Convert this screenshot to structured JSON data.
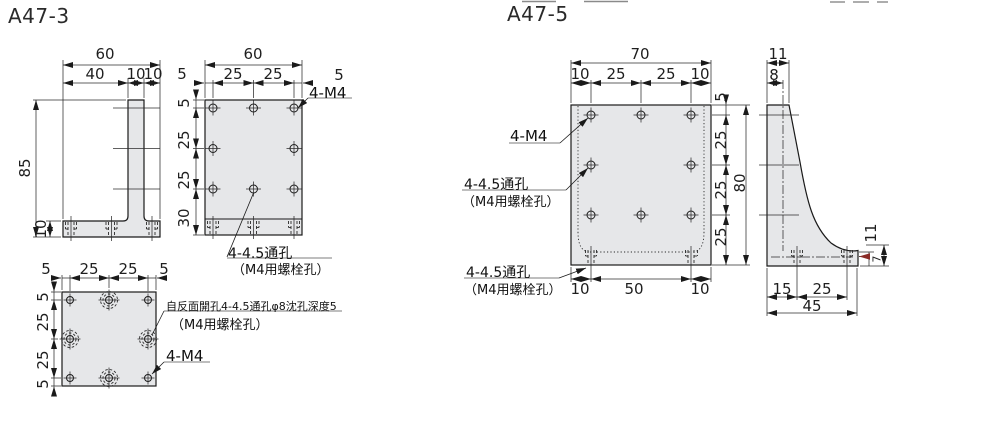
{
  "colors": {
    "background": "#ffffff",
    "part_fill": "#e6e7e9",
    "line": "#1a1a1a",
    "underline_gray": "#a9a9a9",
    "accent_arrow": "#8a2b26"
  },
  "a47_3": {
    "title": "A47-3",
    "side": {
      "w_total": "60",
      "w1": "40",
      "w2": "10",
      "w3": "10",
      "h_total": "85",
      "h_base": "10"
    },
    "front": {
      "w_total": "60",
      "m_l": "5",
      "p1": "25",
      "p2": "25",
      "m_r": "5",
      "v1": "5",
      "v2": "25",
      "v3": "25",
      "v4": "30",
      "tap": "4-M4",
      "hole1": "4-4.5通孔",
      "hole2": "（M4用螺栓孔）"
    },
    "bottom": {
      "m_l": "5",
      "p1": "25",
      "p2": "25",
      "m_r": "5",
      "v1": "5",
      "v2": "25",
      "v3": "25",
      "v4": "5",
      "cbore1": "自反面開孔4-4.5通孔φ8沈孔深度5",
      "cbore2": "（M4用螺栓孔）",
      "tap": "4-M4"
    }
  },
  "a47_5": {
    "title": "A47-5",
    "front": {
      "w_total": "70",
      "m_l": "10",
      "p1": "25",
      "p2": "25",
      "m_r": "10",
      "v1": "5",
      "v2": "25",
      "v3": "25",
      "v4": "25",
      "h_total": "80",
      "b1": "10",
      "b2": "50",
      "b3": "10",
      "tap": "4-M4",
      "hole1": "4-4.5通孔",
      "hole2": "（M4用螺栓孔）",
      "bhole1": "4-4.5通孔",
      "bhole2": "（M4用螺栓孔）"
    },
    "side": {
      "w_top": "11",
      "w_wall": "8",
      "tip_h": "11",
      "tip_t": "7",
      "d1": "15",
      "d2": "25",
      "d_total": "45"
    }
  }
}
